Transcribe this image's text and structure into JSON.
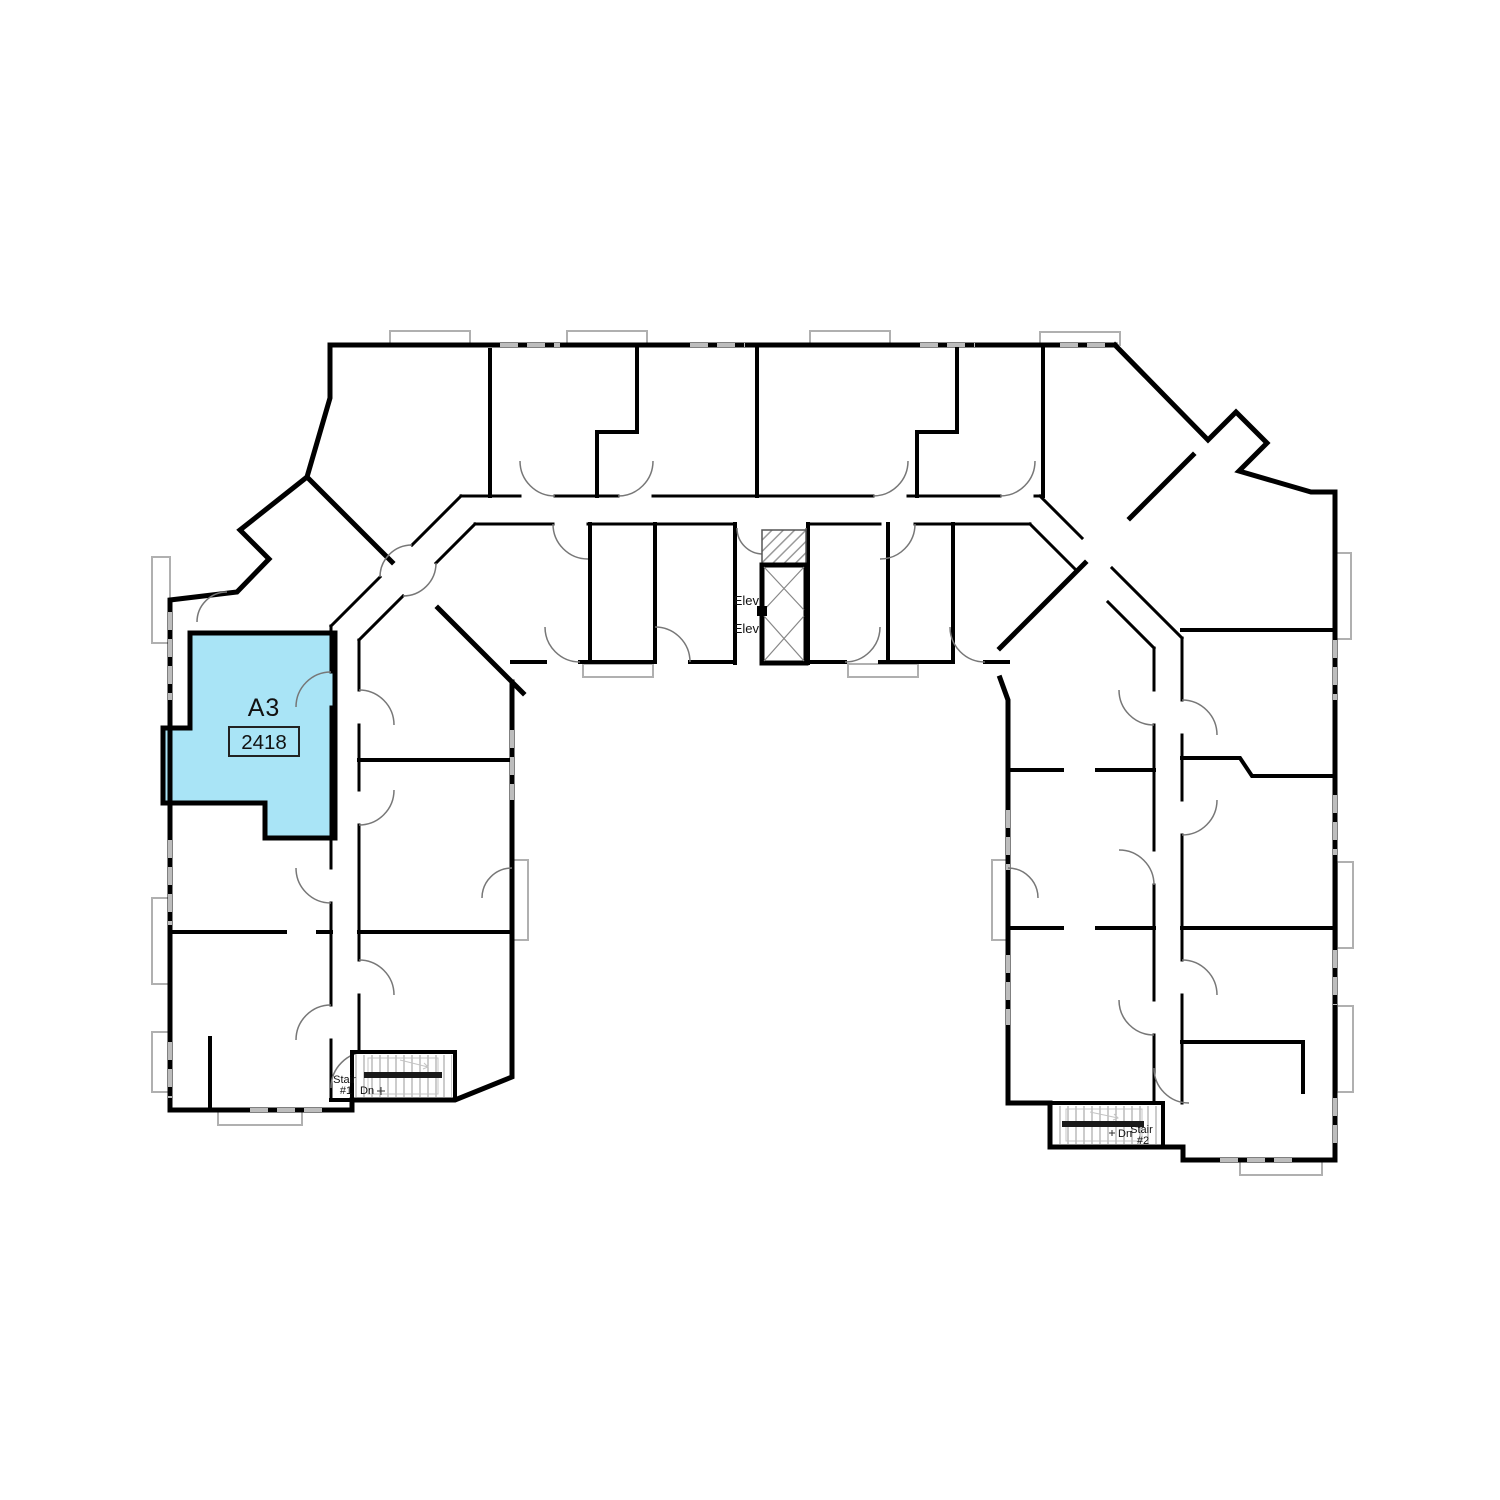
{
  "floor_plan": {
    "highlighted_unit": {
      "label": "A3",
      "number": "2418"
    },
    "elevator": {
      "label_1": "Elev",
      "label_2": "Elev"
    },
    "stairs": {
      "stair1": {
        "name_line1": "Stair",
        "name_line2": "#1",
        "direction_label": "Dn"
      },
      "stair2": {
        "name_line1": "Stair",
        "name_line2": "#2",
        "direction_label": "Dn"
      }
    },
    "colors": {
      "wall": "#000000",
      "highlight": "#a9e4f6",
      "window": "#bdbdbd",
      "background": "#ffffff"
    }
  }
}
